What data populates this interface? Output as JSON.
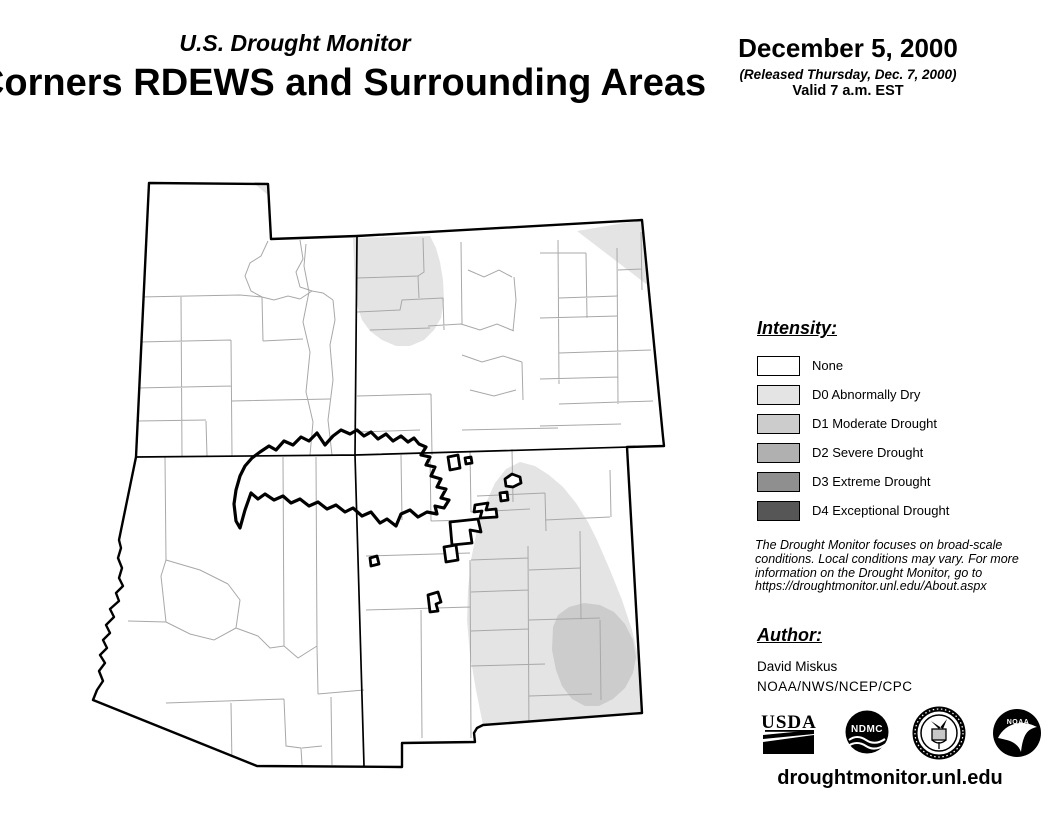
{
  "header": {
    "monitor_title": "U.S. Drought Monitor",
    "region_title": "Four Corners RDEWS and Surrounding Areas",
    "date": "December 5, 2000",
    "released": "(Released Thursday, Dec. 7, 2000)",
    "valid": "Valid 7 a.m. EST"
  },
  "legend": {
    "heading": "Intensity:",
    "items": [
      {
        "label": "None",
        "color": "#ffffff"
      },
      {
        "label": "D0 Abnormally Dry",
        "color": "#e4e4e4"
      },
      {
        "label": "D1 Moderate Drought",
        "color": "#cccccc"
      },
      {
        "label": "D2 Severe Drought",
        "color": "#b0b0b0"
      },
      {
        "label": "D3 Extreme Drought",
        "color": "#8f8f8f"
      },
      {
        "label": "D4 Exceptional Drought",
        "color": "#565656"
      }
    ]
  },
  "disclaimer": {
    "lines": [
      "The Drought Monitor focuses on broad-scale",
      "conditions. Local conditions may vary. For more",
      "information on the Drought Monitor, go to",
      "https://droughtmonitor.unl.edu/About.aspx"
    ]
  },
  "author": {
    "heading": "Author:",
    "name": "David Miskus",
    "affiliation": "NOAA/NWS/NCEP/CPC"
  },
  "logos": [
    {
      "id": "usda-logo",
      "text": "USDA"
    },
    {
      "id": "ndmc-logo",
      "text": "NDMC"
    },
    {
      "id": "commerce-seal-logo",
      "text": ""
    },
    {
      "id": "noaa-logo",
      "text": "NOAA"
    }
  ],
  "footer": {
    "url": "droughtmonitor.unl.edu"
  },
  "map": {
    "states": [
      "Utah",
      "Colorado",
      "Arizona",
      "New Mexico"
    ],
    "line_colors": {
      "county": "#a8a8a8",
      "state": "#000000",
      "tribal_boundary": "#000000"
    },
    "drought_regions": [
      {
        "id": "d0-north-central-colorado",
        "category": "D0 Abnormally Dry"
      },
      {
        "id": "d0-northeast-colorado-corner",
        "category": "D0 Abnormally Dry"
      },
      {
        "id": "d0-east-central-new-mexico",
        "category": "D0 Abnormally Dry"
      },
      {
        "id": "d1-southeast-new-mexico",
        "category": "D1 Moderate Drought"
      }
    ]
  }
}
